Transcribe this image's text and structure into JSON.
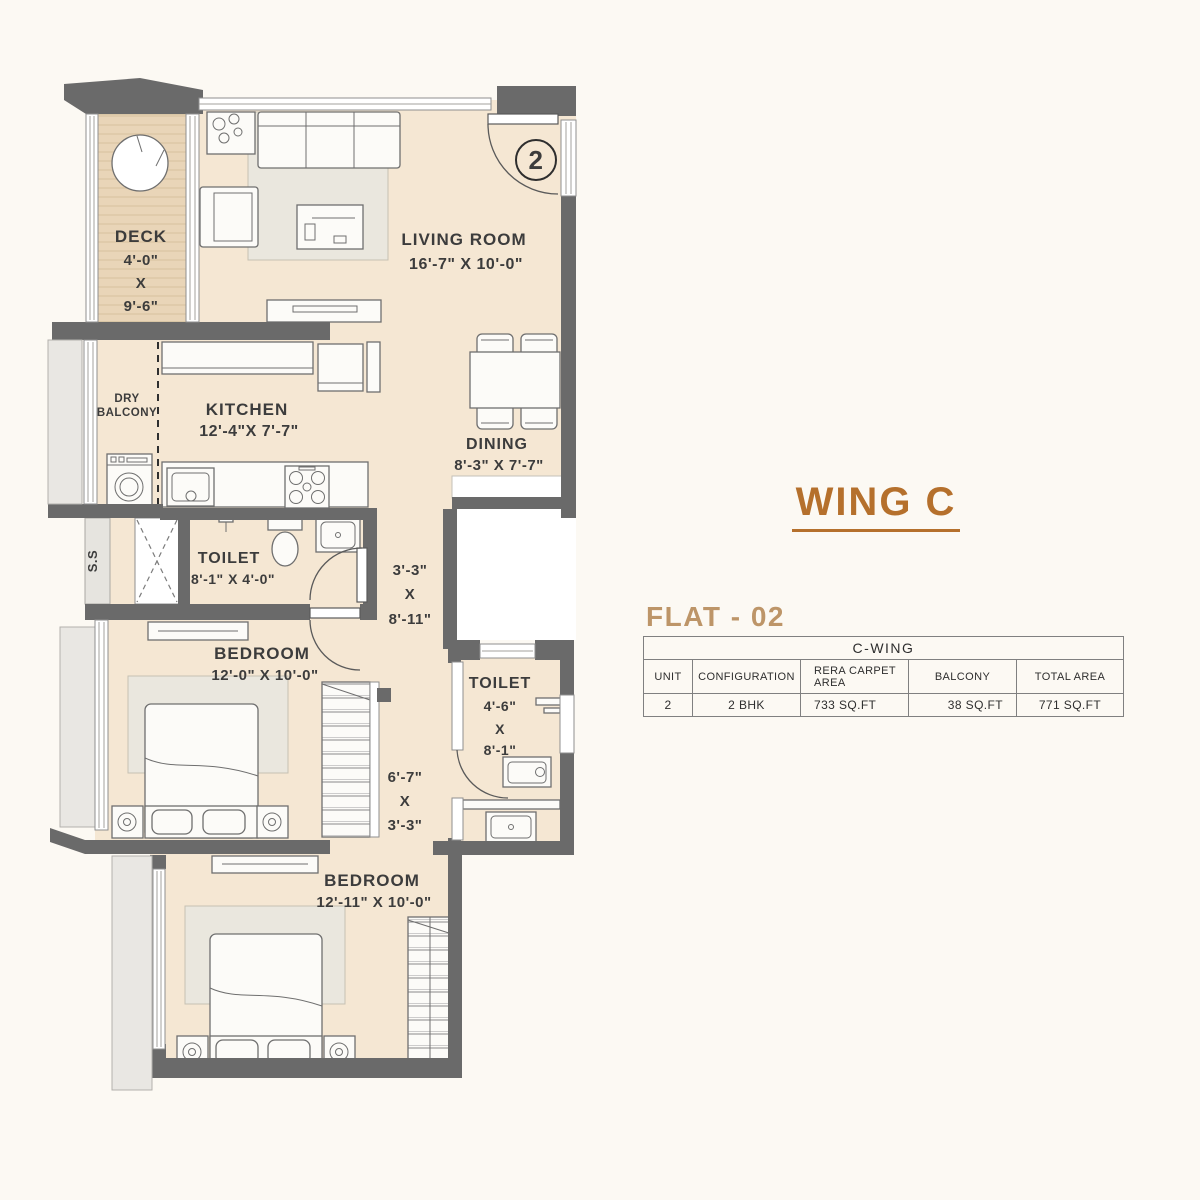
{
  "plan": {
    "unit_circle": "2",
    "shaft_label": "S.S",
    "deck": {
      "name": "DECK",
      "dim_w": "4'-0\"",
      "dim_x": "X",
      "dim_h": "9'-6\""
    },
    "living": {
      "name": "LIVING ROOM",
      "dim": "16'-7\" X 10'-0\""
    },
    "dry_balcony": {
      "line1": "DRY",
      "line2": "BALCONY"
    },
    "kitchen": {
      "name": "KITCHEN",
      "dim": "12'-4\"X 7'-7\""
    },
    "dining": {
      "name": "DINING",
      "dim": "8'-3\" X 7'-7\""
    },
    "toilet1": {
      "name": "TOILET",
      "dim": "8'-1\" X 4'-0\""
    },
    "passage1": {
      "dim_w": "3'-3\"",
      "dim_x": "X",
      "dim_h": "8'-11\""
    },
    "bedroom1": {
      "name": "BEDROOM",
      "dim": "12'-0\" X 10'-0\""
    },
    "toilet2": {
      "name": "TOILET",
      "dim_w": "4'-6\"",
      "dim_x": "X",
      "dim_h": "8'-1\""
    },
    "passage2": {
      "dim_w": "6'-7\"",
      "dim_x": "X",
      "dim_h": "3'-3\""
    },
    "bedroom2": {
      "name": "BEDROOM",
      "dim": "12'-11\" X 10'-0\""
    }
  },
  "panel": {
    "wing_title": "WING C",
    "flat_title": "FLAT - 02",
    "table": {
      "title": "C-WING",
      "columns": [
        "UNIT",
        "CONFIGURATION",
        "RERA  CARPET AREA",
        "BALCONY",
        "TOTAL AREA"
      ],
      "row": [
        "2",
        "2 BHK",
        "733 SQ.FT",
        "38 SQ.FT",
        "771 SQ.FT"
      ]
    }
  },
  "colors": {
    "wall": "#6a6a6a",
    "floor": "#f5e7d3",
    "deck": "#e9d5b8",
    "accent_orange": "#b5702c",
    "flat_title_tan": "#bd9568",
    "label_text": "#3c3c3c"
  }
}
